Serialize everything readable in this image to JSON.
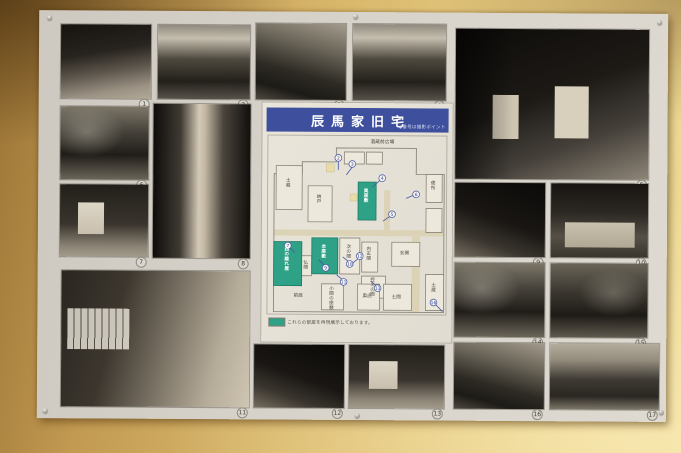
{
  "scene": {
    "wall_color_dark": "#9a7335",
    "wall_color_light": "#f0dd9b",
    "board_color": "#d7d3cb"
  },
  "panel": {
    "title": "辰馬家旧宅",
    "title_note": "◆番号は撮影ポイント",
    "banner_color": "#3d4f9d",
    "highlight_color": "#2fa186",
    "badge_color": "#3f51a0",
    "legend_text": "これらの部屋を再現展示しております。",
    "rooms": [
      "酒蔵前広場",
      "土蔵",
      "納戸",
      "奥座敷",
      "便所",
      "西の離れ屋",
      "本座敷",
      "次の間",
      "内玄関",
      "玄関",
      "控えの間",
      "仏間",
      "小間の座敷",
      "奥店",
      "土間",
      "土蔵",
      "前庭"
    ],
    "points": [
      "2",
      "3",
      "4",
      "5",
      "6",
      "7",
      "9",
      "10",
      "11",
      "12",
      "13",
      "16"
    ]
  },
  "photos": [
    {
      "number": "1"
    },
    {
      "number": "2"
    },
    {
      "number": "3"
    },
    {
      "number": "4"
    },
    {
      "number": "5"
    },
    {
      "number": "6"
    },
    {
      "number": "7"
    },
    {
      "number": "8"
    },
    {
      "number": "9"
    },
    {
      "number": "10"
    },
    {
      "number": "11"
    },
    {
      "number": "12"
    },
    {
      "number": "13"
    },
    {
      "number": "14"
    },
    {
      "number": "15"
    },
    {
      "number": "16"
    },
    {
      "number": "17"
    }
  ]
}
